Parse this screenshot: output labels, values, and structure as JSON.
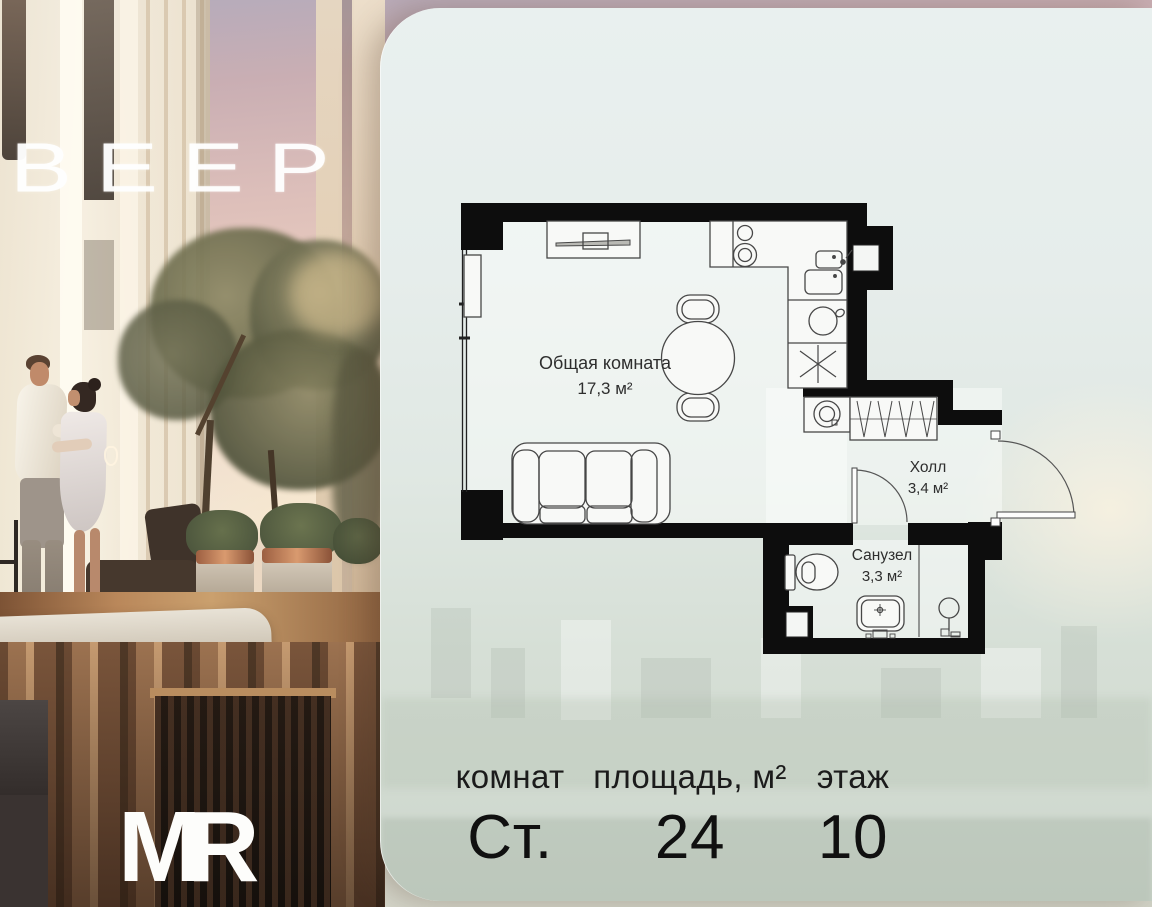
{
  "branding": {
    "logo_text": "ВЕЕР",
    "brand_mark": "MR"
  },
  "floor_plan": {
    "rooms": [
      {
        "name": "Общая комната",
        "area": "17,3 м²"
      },
      {
        "name": "Холл",
        "area": "3,4 м²"
      },
      {
        "name": "Санузел",
        "area": "3,3 м²"
      }
    ]
  },
  "summary": {
    "columns": [
      {
        "label": "комнат",
        "value": "Ст."
      },
      {
        "label": "площадь, м²",
        "value": "24"
      },
      {
        "label": "этаж",
        "value": "10"
      }
    ]
  },
  "colors": {
    "wall": "#0d0d0d",
    "panel_tint": "#e7eeec",
    "accent_copper": "#b97a55",
    "text_dark": "#1a1a1a"
  }
}
